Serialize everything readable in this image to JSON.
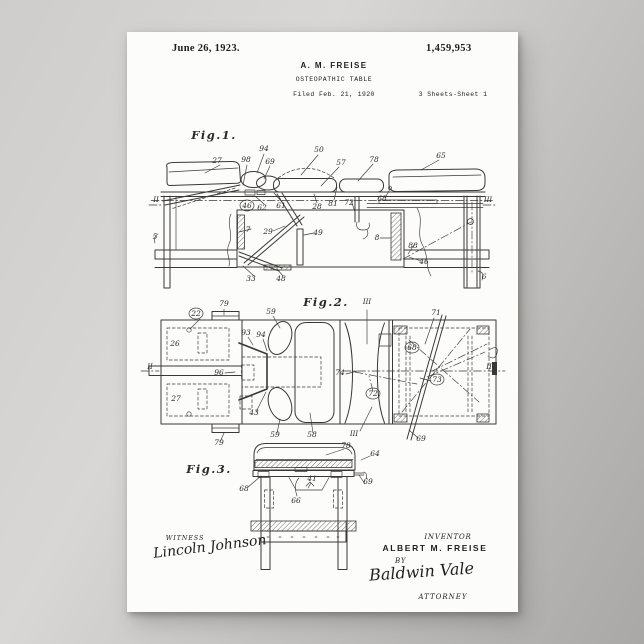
{
  "header": {
    "date": "June 26, 1923.",
    "patent_number": "1,459,953",
    "inventor_short": "A. M. FREISE",
    "doc_title": "OSTEOPATHIC TABLE",
    "filed": "Filed Feb. 21, 1920",
    "sheet": "3 Sheets-Sheet 1"
  },
  "footer": {
    "witness_label": "WITNESS",
    "witness_signature": "Lincoln Johnson",
    "inventor_label": "INVENTOR",
    "inventor_name": "ALBERT M. FREISE",
    "by_label": "BY",
    "attorney_signature": "Baldwin Vale",
    "attorney_label": "ATTORNEY"
  },
  "drawing": {
    "ink_color": "#3b3935",
    "paper_color": "#fcfcfa",
    "labels": [
      {
        "text": "Fig.1.",
        "x": 87,
        "y": 107,
        "cls": "figtitle"
      },
      {
        "text": "27",
        "x": 90,
        "y": 131
      },
      {
        "text": "98",
        "x": 119,
        "y": 130
      },
      {
        "text": "94",
        "x": 137,
        "y": 119
      },
      {
        "text": "69",
        "x": 143,
        "y": 132
      },
      {
        "text": "50",
        "x": 192,
        "y": 120
      },
      {
        "text": "57",
        "x": 214,
        "y": 133
      },
      {
        "text": "78",
        "x": 247,
        "y": 130
      },
      {
        "text": "65",
        "x": 314,
        "y": 126
      },
      {
        "text": "II",
        "x": 29,
        "y": 170,
        "cls": "sm"
      },
      {
        "text": "III",
        "x": 361,
        "y": 170,
        "cls": "sm"
      },
      {
        "text": "46",
        "x": 120,
        "y": 176,
        "circled": true
      },
      {
        "text": "62",
        "x": 135,
        "y": 178
      },
      {
        "text": "61",
        "x": 154,
        "y": 176
      },
      {
        "text": "28",
        "x": 190,
        "y": 177
      },
      {
        "text": "81",
        "x": 206,
        "y": 174
      },
      {
        "text": "72",
        "x": 222,
        "y": 173
      },
      {
        "text": "68",
        "x": 255,
        "y": 169
      },
      {
        "text": "5",
        "x": 28,
        "y": 207
      },
      {
        "text": "7",
        "x": 121,
        "y": 200
      },
      {
        "text": "29",
        "x": 141,
        "y": 202
      },
      {
        "text": "49",
        "x": 191,
        "y": 203
      },
      {
        "text": "8",
        "x": 250,
        "y": 208
      },
      {
        "text": "88",
        "x": 286,
        "y": 216
      },
      {
        "text": "46",
        "x": 297,
        "y": 232
      },
      {
        "text": "33",
        "x": 124,
        "y": 249
      },
      {
        "text": "48",
        "x": 154,
        "y": 249
      },
      {
        "text": "6",
        "x": 357,
        "y": 247
      },
      {
        "text": "Fig.2.",
        "x": 199,
        "y": 274,
        "cls": "figtitle"
      },
      {
        "text": "22",
        "x": 69,
        "y": 284,
        "circled": true
      },
      {
        "text": "79",
        "x": 97,
        "y": 274
      },
      {
        "text": "59",
        "x": 144,
        "y": 282
      },
      {
        "text": "III",
        "x": 240,
        "y": 272,
        "cls": "sm"
      },
      {
        "text": "71",
        "x": 309,
        "y": 283
      },
      {
        "text": "26",
        "x": 48,
        "y": 314
      },
      {
        "text": "93",
        "x": 119,
        "y": 303
      },
      {
        "text": "94",
        "x": 134,
        "y": 305
      },
      {
        "text": "68",
        "x": 285,
        "y": 318,
        "circled": true
      },
      {
        "text": "96",
        "x": 92,
        "y": 343
      },
      {
        "text": "74",
        "x": 213,
        "y": 343
      },
      {
        "text": "73",
        "x": 310,
        "y": 350,
        "circled": true
      },
      {
        "text": "27",
        "x": 49,
        "y": 369
      },
      {
        "text": "72",
        "x": 246,
        "y": 364,
        "circled": true
      },
      {
        "text": "43",
        "x": 127,
        "y": 383
      },
      {
        "text": "59",
        "x": 148,
        "y": 405
      },
      {
        "text": "58",
        "x": 185,
        "y": 405
      },
      {
        "text": "III",
        "x": 227,
        "y": 404,
        "cls": "sm"
      },
      {
        "text": "69",
        "x": 294,
        "y": 409
      },
      {
        "text": "79",
        "x": 92,
        "y": 413
      },
      {
        "text": "II",
        "x": 23,
        "y": 337,
        "cls": "sm"
      },
      {
        "text": "II",
        "x": 362,
        "y": 337,
        "cls": "sm"
      },
      {
        "text": "78",
        "x": 219,
        "y": 416
      },
      {
        "text": "64",
        "x": 248,
        "y": 424
      },
      {
        "text": "Fig.3.",
        "x": 82,
        "y": 441,
        "cls": "figtitle"
      },
      {
        "text": "68",
        "x": 117,
        "y": 459
      },
      {
        "text": "41",
        "x": 185,
        "y": 449
      },
      {
        "text": "69",
        "x": 241,
        "y": 452
      },
      {
        "text": "66",
        "x": 169,
        "y": 471
      }
    ]
  }
}
